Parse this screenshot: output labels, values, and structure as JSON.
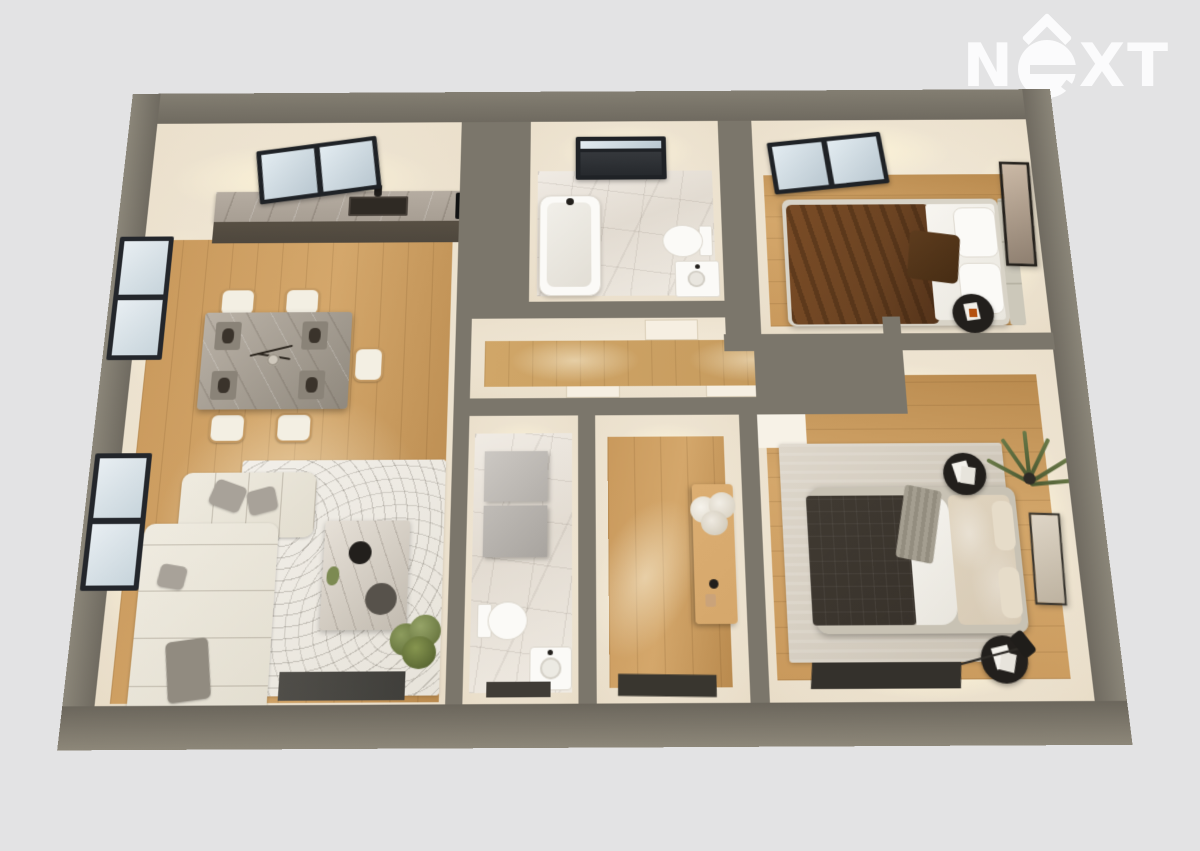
{
  "logo": {
    "n": "N",
    "xt": "XT",
    "brand": "NEXT"
  },
  "colors": {
    "bg": "#e3e3e4",
    "logo": "#fbfbfc",
    "wall": "#7b766b",
    "cream": "#ece2cf",
    "wood": "#c9995c",
    "wood-light": "#d4a76b",
    "wood-dark": "#b98a4e",
    "hall-wood": "#d0a668",
    "marble": "#ece6de",
    "counter": "#a79e93",
    "cabinet": "#4e473d",
    "frame": "#24272b",
    "glass": "#dde8ee",
    "sofa": "#ebe7dc",
    "bed-brown": "#6b4322",
    "bed-dark": "#38322b",
    "duvet": "#d6c9b4",
    "black": "#221f1c",
    "green": "#76854a",
    "tan": "#d5a76b",
    "white": "#f7f5f0"
  }
}
